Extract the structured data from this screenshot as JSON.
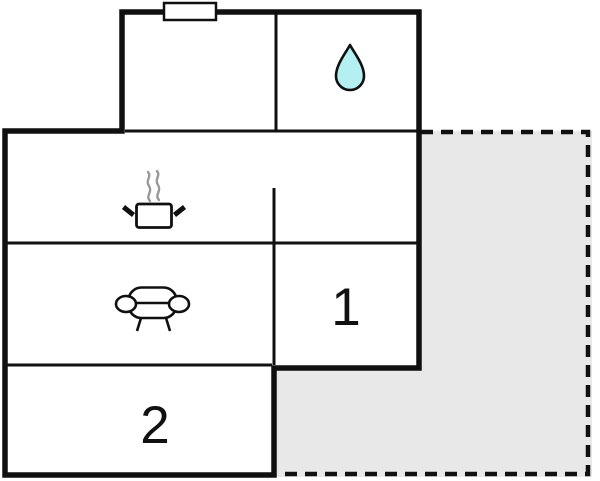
{
  "floor_plan": {
    "room_labels": {
      "room1": "1",
      "room2": "2"
    },
    "icons": {
      "bathroom_icon": "water-drop-icon",
      "kitchen_icon": "cooking-pot-icon",
      "living_room_icon": "sofa-icon",
      "window_marker": "window-icon"
    },
    "colors": {
      "wall": "#101010",
      "background": "#ffffff",
      "terrace_fill": "#e8e8e8",
      "drop_fill": "#b4f0f2",
      "steam": "#999999",
      "label": "#111111"
    }
  }
}
